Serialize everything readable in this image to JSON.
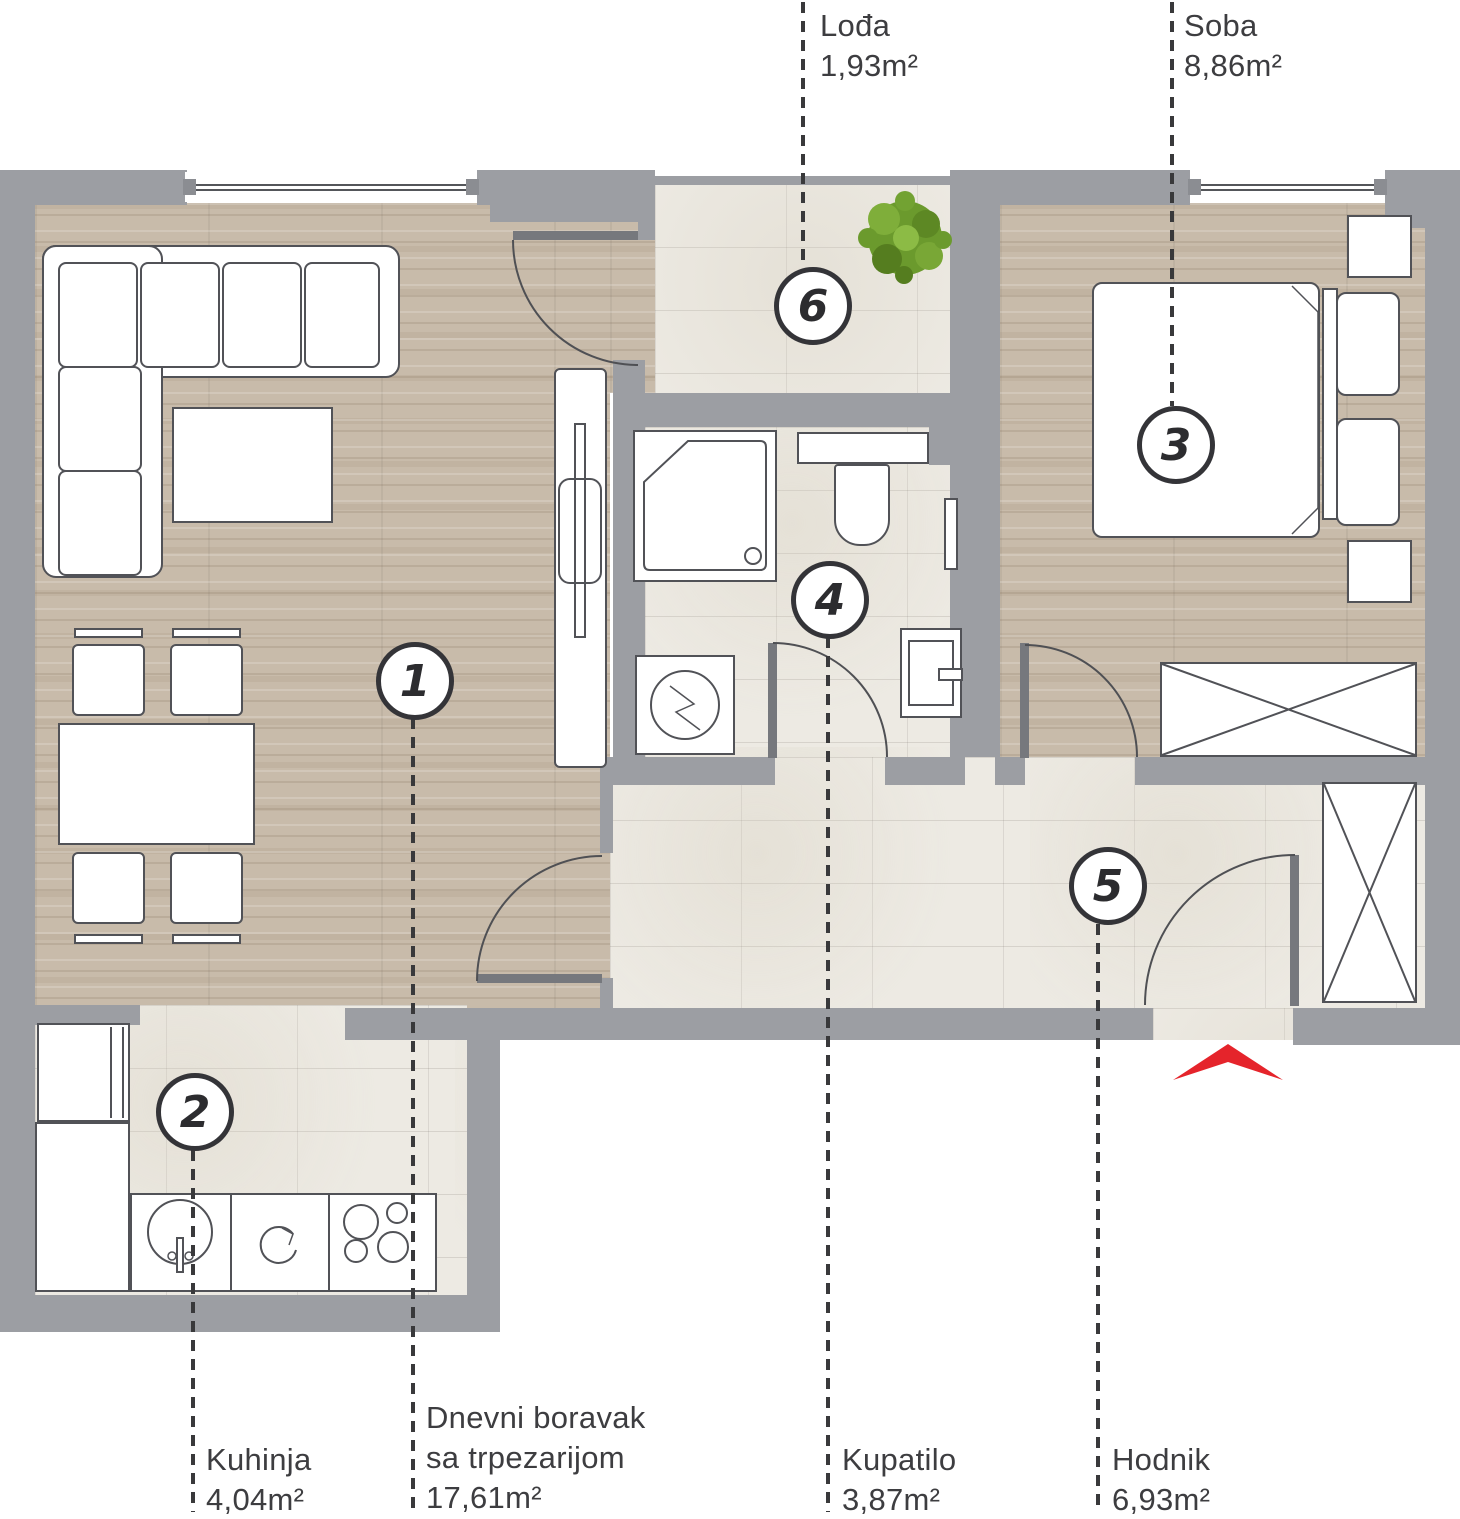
{
  "plan_title": "Apartment floor plan",
  "rooms": [
    {
      "number": "1",
      "name": "Dnevni boravak sa trpezarijom",
      "name_line1": "Dnevni boravak",
      "name_line2": "sa trpezarijom",
      "area": "17,61m²"
    },
    {
      "number": "2",
      "name": "Kuhinja",
      "area": "4,04m²"
    },
    {
      "number": "3",
      "name": "Soba",
      "area": "8,86m²"
    },
    {
      "number": "4",
      "name": "Kupatilo",
      "area": "3,87m²"
    },
    {
      "number": "5",
      "name": "Hodnik",
      "area": "6,93m²"
    },
    {
      "number": "6",
      "name": "Lođa",
      "area": "1,93m²"
    }
  ],
  "icons": {
    "entry_arrow": "red chevron pointing up at apartment entrance",
    "plant": "green shrub seen from above on loggia",
    "sink": "kitchen sink circle with tap",
    "oven": "circular arrow burner symbol",
    "cooktop": "four burner circles",
    "washing_machine": "square with drum circle and zigzag",
    "wardrobe": "rectangle with X cross"
  },
  "colors": {
    "wall": "#9c9ea3",
    "wood_floor": "#c8bbaa",
    "tile_floor": "#edeae3",
    "entry_arrow": "#e5242b",
    "plant_green": "#6b9a2d",
    "line_dark": "#3c3c3e"
  }
}
